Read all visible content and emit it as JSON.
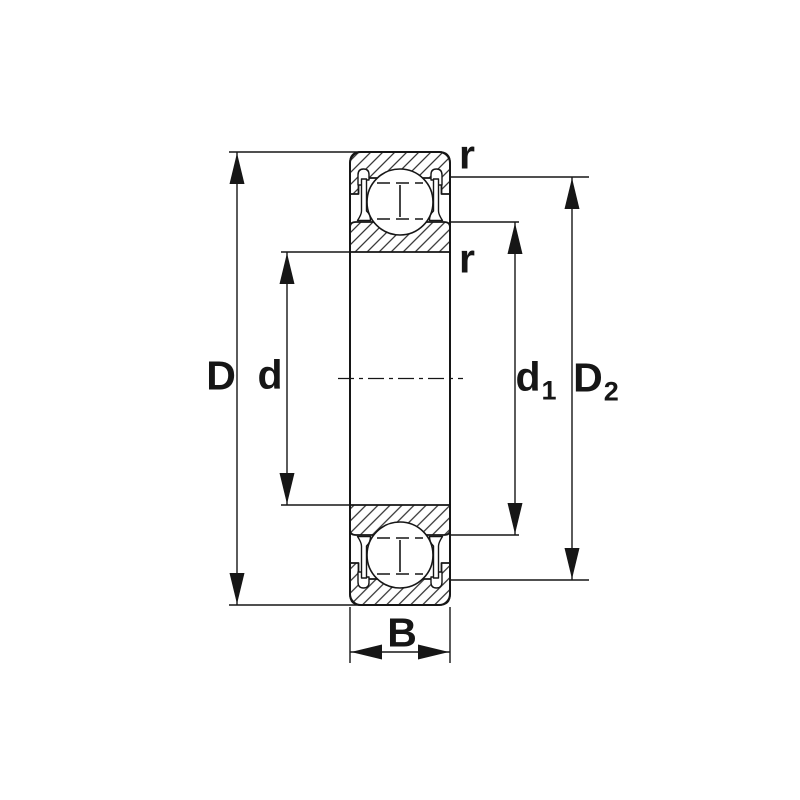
{
  "canvas": {
    "background": "#ffffff",
    "ink": "#161616"
  },
  "drawing": {
    "kind": "ball-bearing-cross-section"
  },
  "labels": {
    "outer_diameter": "D",
    "bore_diameter": "d",
    "shoulder_diameter": {
      "main": "d",
      "sub": "1"
    },
    "recess_diameter": {
      "main": "D",
      "sub": "2"
    },
    "width": "B",
    "radius_outer": "r",
    "radius_inner": "r"
  }
}
